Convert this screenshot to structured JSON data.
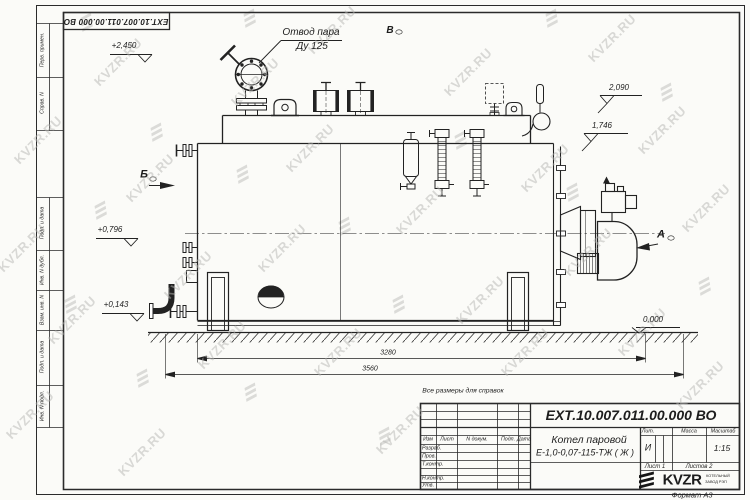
{
  "watermark": {
    "text": "KVZR.RU"
  },
  "frame": {
    "top_stamp": "ЕХТ.10.007.011.00.000  ВО",
    "format_label": "Формат А3",
    "side_columns": [
      "Перв. примен.",
      "Справ. N",
      "Подп. и дата",
      "Инв. N дубл.",
      "Взам. инв. N",
      "Подп. и дата",
      "Инв. N подл."
    ]
  },
  "drawing": {
    "callout_line1": "Отвод пара",
    "callout_line2": "Ду 125",
    "view_b": "Б",
    "view_v": "В",
    "view_a": "А",
    "elev_2450": "+2,450",
    "elev_2090": "2,090",
    "elev_1746": "1,746",
    "elev_0796": "+0,796",
    "elev_0143": "+0,143",
    "elev_0000": "0,000",
    "dim_3280": "3280",
    "dim_3560": "3560",
    "note": "Все размеры для справок"
  },
  "title_block": {
    "doc_number": "ЕХТ.10.007.011.00.000  ВО",
    "product_name": "Котел паровой",
    "product_code": "Е-1,0-0,07-115-ТЖ ( Ж )",
    "col_izm": "Изм",
    "col_list": "Лист",
    "col_doc": "N докум.",
    "col_podp": "Подп.",
    "col_data": "Дата",
    "row_razrab": "Разраб.",
    "row_prov": "Пров.",
    "row_tkontr": "Т.контр.",
    "row_nkontr": "Н.контр.",
    "row_utv": "Утв.",
    "lit_label": "Лит.",
    "mass_label": "Масса",
    "scale_label": "Масштаб",
    "lit_value": "И",
    "scale_value": "1:15",
    "sheet": "Лист 1",
    "sheets": "Листов 2",
    "logo_text": "KVZR",
    "logo_sub1": "КОТЕЛЬНЫЙ",
    "logo_sub2": "ЗАВОД РЭП"
  }
}
